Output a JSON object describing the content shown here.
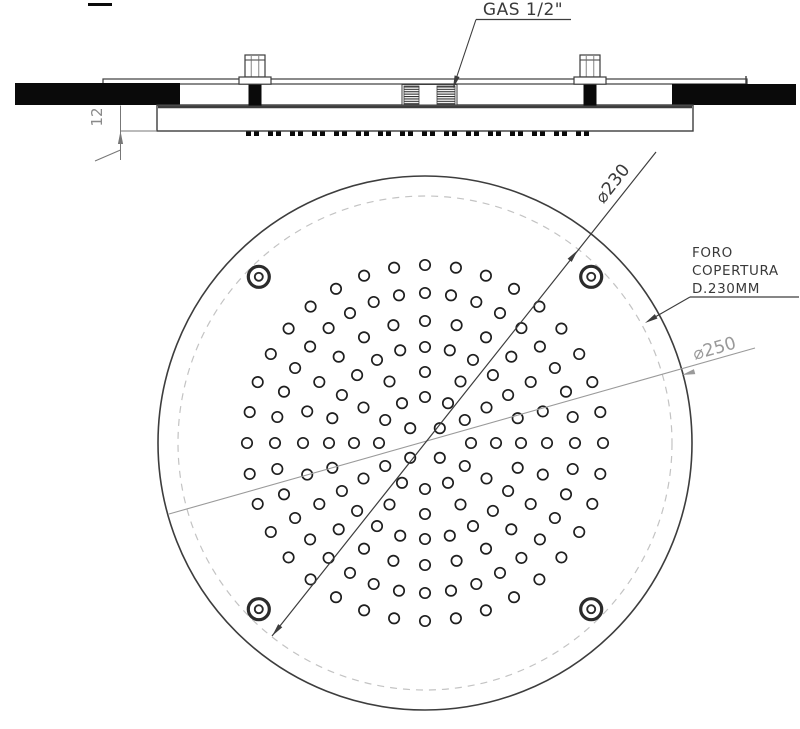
{
  "drawing_type": "technical-drawing-shower-head",
  "labels": {
    "gas": "GAS 1/2\"",
    "dim12": "12",
    "dia230": "⌀230",
    "dia250": "⌀250",
    "foro_line1": "FORO",
    "foro_line2": "COPERTURA",
    "foro_line3": "D.230MM"
  },
  "colors": {
    "ink": "#3d3d3d",
    "text_ink": "#3a3a3a",
    "dim_gray": "#9a9a9a",
    "dash_circle": "#c3c3c3",
    "black_fill": "#0a0a0a",
    "background": "#ffffff"
  },
  "geometry": {
    "plan": {
      "cx": 425,
      "cy": 443,
      "outer_r": 267,
      "dashed_r": 247,
      "screws": {
        "r": 235,
        "angles": [
          45,
          135,
          225,
          315
        ],
        "outer_r": 10.5,
        "inner_r": 4
      },
      "nozzle_rings": [
        {
          "r": 21,
          "count": 4,
          "offset": 45
        },
        {
          "r": 46,
          "count": 12,
          "offset": 0
        },
        {
          "r": 71,
          "count": 12,
          "offset": 0
        },
        {
          "r": 96,
          "count": 24,
          "offset": 0
        },
        {
          "r": 122,
          "count": 24,
          "offset": 0
        },
        {
          "r": 150,
          "count": 36,
          "offset": 0
        },
        {
          "r": 178,
          "count": 36,
          "offset": 0
        }
      ],
      "nozzle_r": 5.2
    },
    "side": {
      "bolts": [
        255,
        590
      ],
      "dash_strip": {
        "x1": 246,
        "x2": 601,
        "y": 131.5,
        "h": 4.5
      }
    }
  }
}
